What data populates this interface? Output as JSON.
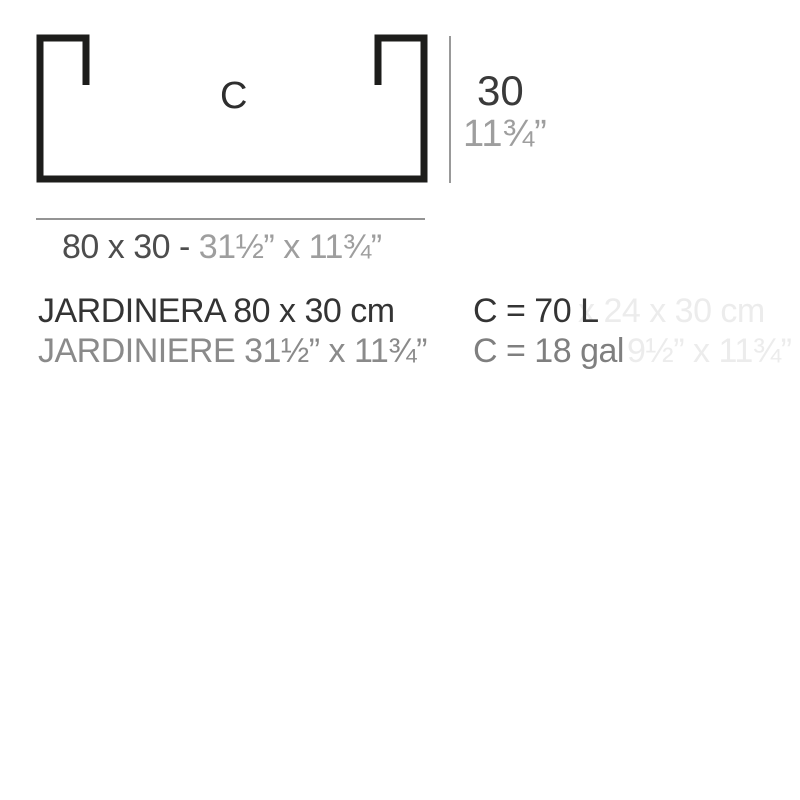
{
  "diagram": {
    "profile_label": "C",
    "height_dimension": {
      "cm": "30",
      "inches": "11¾”"
    },
    "width_dimension": {
      "metric": "80 x 30 - ",
      "imperial": "31½” x 11¾”"
    }
  },
  "product": {
    "name_spanish": "JARDINERA 80 x 30 cm",
    "name_french": "JARDINIERE 31½” x 11¾”"
  },
  "capacity": {
    "liters": "C = 70 L",
    "gallons": "C = 18 gal"
  },
  "ghost_text": {
    "line1": "x 24 x 30 cm",
    "line2": "9½” x 11¾”"
  },
  "colors": {
    "profile_stroke": "#1d1d1b",
    "text_dark": "#343434",
    "text_gray": "#9e9e9e",
    "text_medium_gray": "#8a8a8a",
    "dimension_line": "#999999",
    "ghost": "#ececec",
    "background": "#ffffff"
  }
}
